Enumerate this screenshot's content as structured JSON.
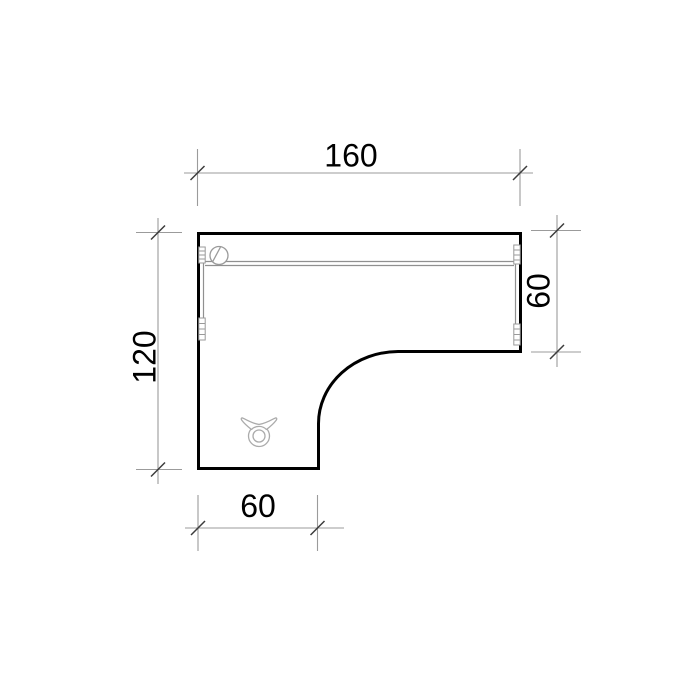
{
  "diagram": {
    "kind": "furniture-plan-technical-drawing",
    "subject": "L-shaped desk, top (plan) view",
    "dimensions": {
      "top_width": "160",
      "left_height": "120",
      "right_depth": "60",
      "bottom_leg_width": "60"
    },
    "colors": {
      "background": "#ffffff",
      "desk_outline": "#000000",
      "detail_lines": "#909090",
      "dimension_lines": "#9b9b9b",
      "tick_marks": "#3c3c3c",
      "dimension_text": "#000000"
    },
    "symbols": {
      "grommet": "cable-grommet-circle-icon",
      "cable_tray": "cable-tray-double-line",
      "edge_connectors": "edge-connector-bracket",
      "cable_clip": "trefoil-cable-clip-icon"
    }
  }
}
